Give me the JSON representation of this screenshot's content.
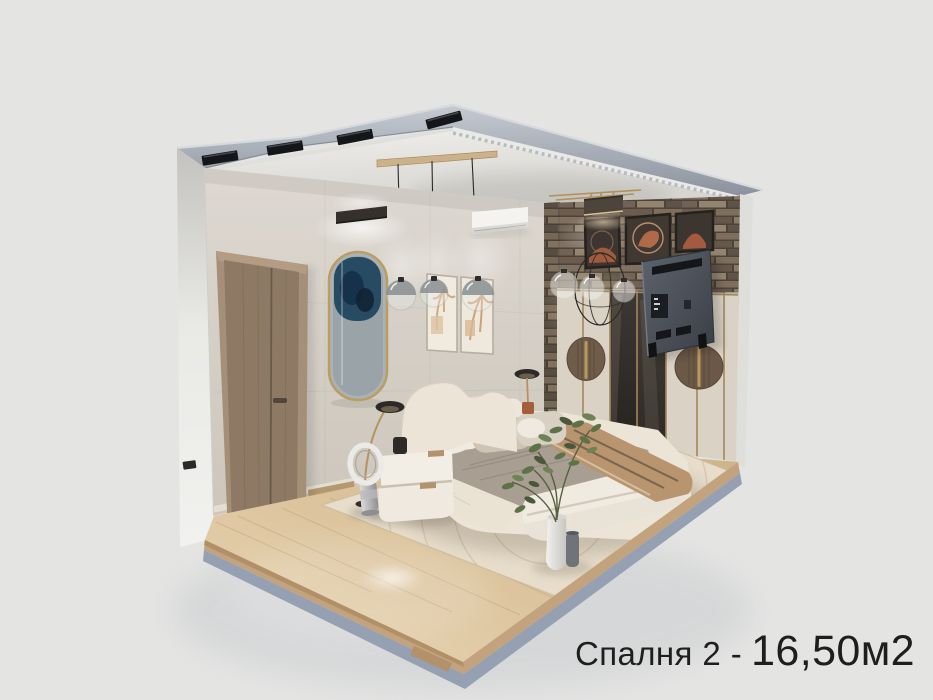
{
  "meta": {
    "description": "3D cutaway (dollhouse) render of a modern bedroom interior on a plain light background",
    "view": "isometric cutaway from above front-right"
  },
  "caption": {
    "room_label": "Спалня 2 -",
    "area_value": "16,50м2"
  },
  "palette": {
    "background": "#e4e4e3",
    "text": "#1e1e1e",
    "wall_plaster": "#d7d2ca",
    "ceiling": "#e9e7e3",
    "roof_slab": "#a7adb6",
    "floor_wood": "#d9c09b",
    "floor_edge_wood": "#c2a37d",
    "floor_cut_edge": "#95a1b2",
    "stone_wall": "#81705f",
    "door_wood": "#8d7964",
    "wardrobe_cream": "#d9d2c5",
    "brass_accent": "#b0905c",
    "bedding_cream": "#eae2d4",
    "bedding_gray": "#a89e91",
    "throw_tan": "#b8946f",
    "tv_back": "#4b5058",
    "plant_green": "#5d7247"
  },
  "scene": {
    "room": "bedroom",
    "objects": [
      "ceiling track lights",
      "wood ceiling plank",
      "glass globe pendants",
      "wall sconce",
      "oval gold-framed mirror",
      "wood door",
      "framed botanical prints",
      "air conditioner",
      "stone accent wall",
      "dark gallery frames",
      "box pendant lamp",
      "globe chandelier",
      "wall-mounted tv seen from back",
      "wardrobe with brass medallions",
      "upholstered bed",
      "pillows",
      "striped knit throw",
      "white two-tier nightstand",
      "bladeless fan",
      "arc floor lamp",
      "reading lamp",
      "potted plant",
      "ceramic vases",
      "area rug",
      "wood floor platform"
    ]
  }
}
